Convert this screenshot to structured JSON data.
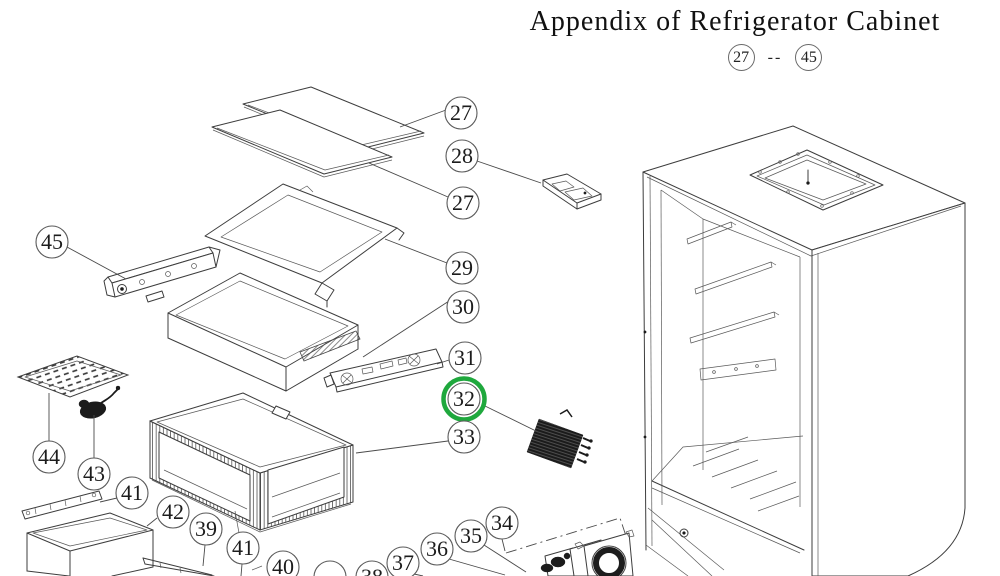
{
  "title": "Appendix of Refrigerator Cabinet",
  "range": {
    "start": "27",
    "separator": "--",
    "end": "45"
  },
  "highlight": {
    "part": "32",
    "color": "#1fa83d"
  },
  "callouts": [
    {
      "label": "27",
      "cx": 461,
      "cy": 113,
      "leader": [
        [
          446,
          110
        ],
        [
          400,
          127
        ]
      ]
    },
    {
      "label": "28",
      "cx": 462,
      "cy": 156,
      "leader": [
        [
          477,
          161
        ],
        [
          541,
          183
        ]
      ]
    },
    {
      "label": "27",
      "cx": 463,
      "cy": 203,
      "leader": [
        [
          448,
          197
        ],
        [
          369,
          163
        ]
      ]
    },
    {
      "label": "29",
      "cx": 462,
      "cy": 268,
      "leader": [
        [
          447,
          263
        ],
        [
          385,
          239
        ]
      ]
    },
    {
      "label": "30",
      "cx": 463,
      "cy": 307,
      "leader": [
        [
          449,
          301
        ],
        [
          363,
          357
        ]
      ]
    },
    {
      "label": "31",
      "cx": 465,
      "cy": 358,
      "leader": [
        [
          449,
          360
        ],
        [
          437,
          364
        ]
      ]
    },
    {
      "label": "32",
      "cx": 464,
      "cy": 399,
      "highlight": true,
      "leader": [
        [
          485,
          406
        ],
        [
          538,
          432
        ]
      ]
    },
    {
      "label": "33",
      "cx": 464,
      "cy": 437,
      "leader": [
        [
          448,
          441
        ],
        [
          356,
          453
        ]
      ]
    },
    {
      "label": "45",
      "cx": 52,
      "cy": 242,
      "leader": [
        [
          67,
          247
        ],
        [
          126,
          279
        ]
      ]
    },
    {
      "label": "44",
      "cx": 49,
      "cy": 457,
      "leader": [
        [
          49,
          441
        ],
        [
          49,
          393
        ]
      ]
    },
    {
      "label": "43",
      "cx": 94,
      "cy": 474,
      "leader": [
        [
          94,
          458
        ],
        [
          94,
          415
        ]
      ]
    },
    {
      "label": "41",
      "cx": 132,
      "cy": 493,
      "leader": [
        [
          117,
          498
        ],
        [
          100,
          502
        ]
      ]
    },
    {
      "label": "42",
      "cx": 173,
      "cy": 512,
      "leader": [
        [
          157,
          518
        ],
        [
          147,
          526
        ]
      ]
    },
    {
      "label": "39",
      "cx": 206,
      "cy": 529,
      "leader": [
        [
          205,
          545
        ],
        [
          203,
          566
        ]
      ]
    },
    {
      "label": "41",
      "cx": 243,
      "cy": 548,
      "leader": [
        [
          242,
          564
        ],
        [
          241,
          576
        ]
      ]
    },
    {
      "label": "40",
      "cx": 283,
      "cy": 567,
      "leader": []
    },
    {
      "label": "",
      "cx": 330,
      "cy": 577,
      "leader": []
    },
    {
      "label": "38",
      "cx": 372,
      "cy": 577,
      "leader": []
    },
    {
      "label": "37",
      "cx": 403,
      "cy": 563,
      "leader": [
        [
          414,
          574
        ],
        [
          423,
          576
        ]
      ]
    },
    {
      "label": "36",
      "cx": 437,
      "cy": 549,
      "leader": [
        [
          449,
          559
        ],
        [
          505,
          575
        ]
      ]
    },
    {
      "label": "35",
      "cx": 471,
      "cy": 536,
      "leader": [
        [
          484,
          545
        ],
        [
          526,
          572
        ]
      ]
    },
    {
      "label": "34",
      "cx": 502,
      "cy": 523,
      "leader": [
        [
          502,
          539
        ],
        [
          505,
          551
        ]
      ]
    }
  ]
}
